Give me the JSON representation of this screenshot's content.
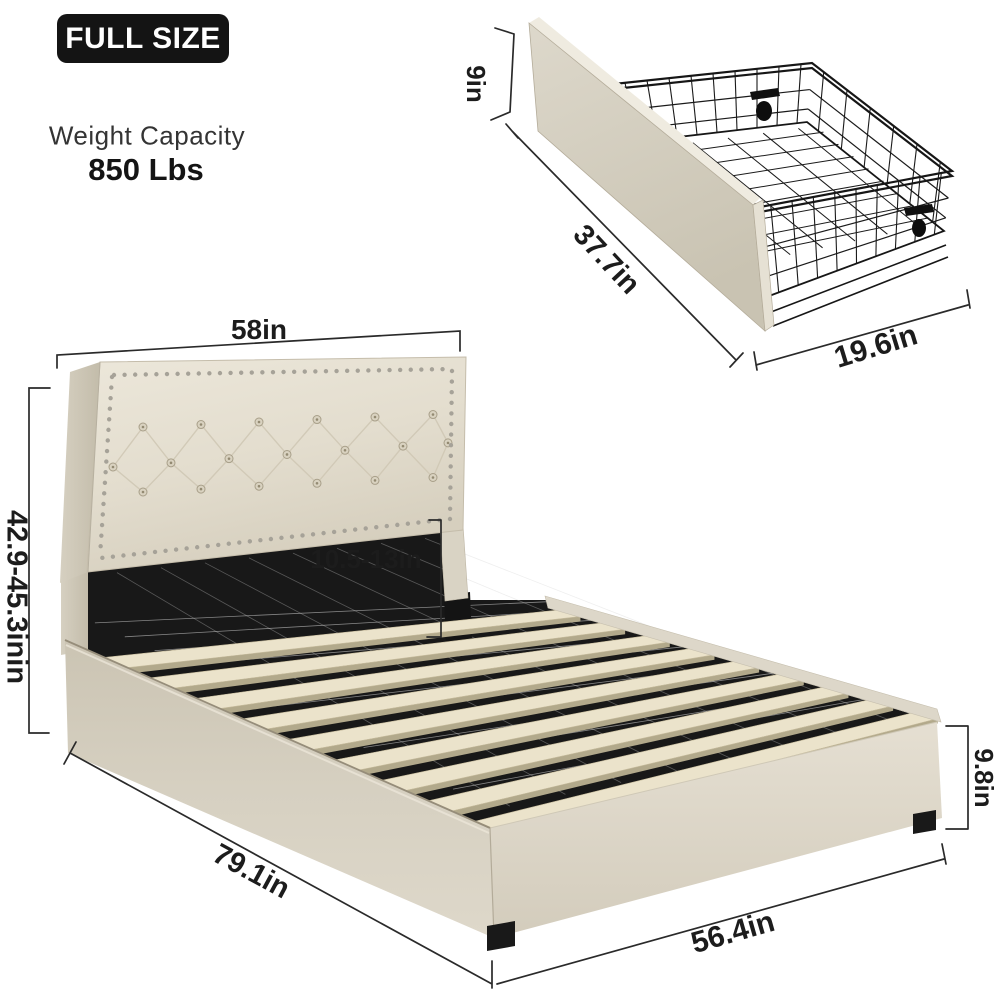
{
  "badge": {
    "label": "FULL SIZE"
  },
  "capacity": {
    "title": "Weight Capacity",
    "value": "850 Lbs"
  },
  "drawer": {
    "height_label": "9in",
    "length_label": "37.7in",
    "width_label": "19.6in"
  },
  "bed": {
    "headboard_width_label": "58in",
    "headboard_height_label": "42.9-45.3inin",
    "headboard_to_slat_label": "10.5-13in",
    "length_label": "79.1in",
    "width_label": "56.4in",
    "rail_height_label": "9.8in"
  },
  "colors": {
    "badge_bg": "#141414",
    "label_text": "#1c1c1c",
    "dim_line": "#2a2a2a",
    "fabric_light": "#eae5d8",
    "fabric_mid": "#d8d2c2",
    "fabric_dark": "#c6bfae",
    "slat_wood": "#ebe3cb",
    "wire_black": "#1a1a1a",
    "nailhead": "#a6a298"
  }
}
